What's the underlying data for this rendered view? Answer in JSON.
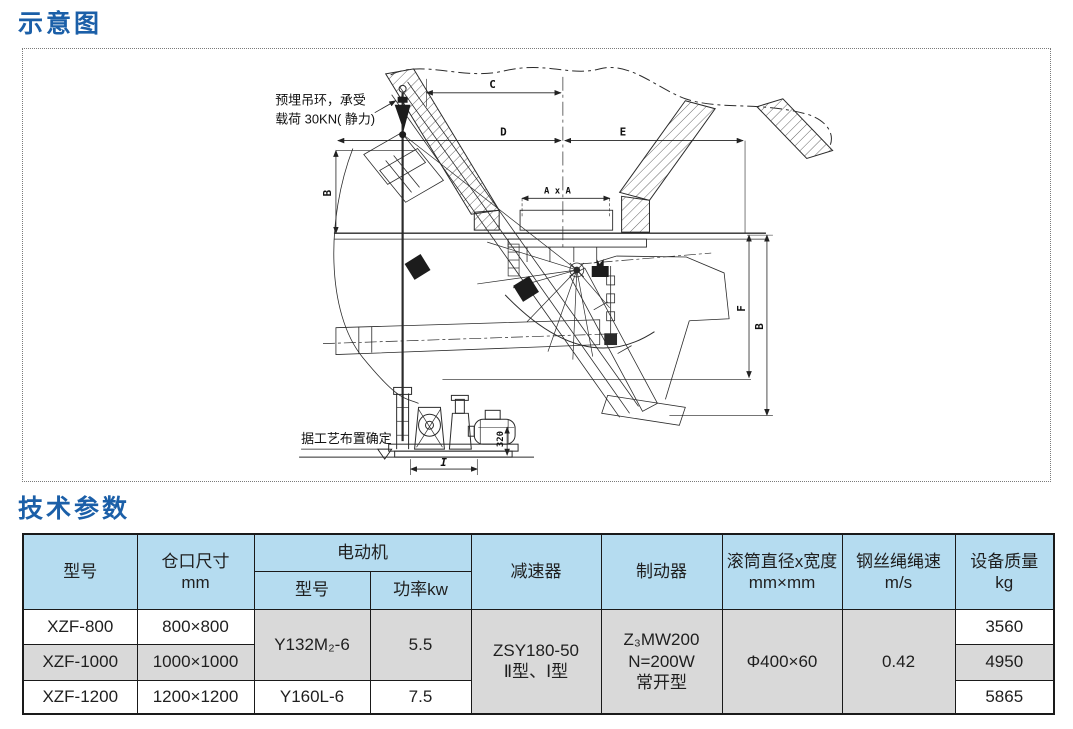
{
  "schematic": {
    "title": "示意图",
    "annotations": {
      "lifting_line1": "预埋吊环，承受",
      "lifting_line2": "载荷 30KN( 静力)",
      "process_note": "据工艺布置确定"
    },
    "dimensions": {
      "c": "C",
      "d": "D",
      "e": "E",
      "axa": "A x A",
      "b_left": "B",
      "f": "F",
      "b_right": "B",
      "i": "I",
      "h320": "320"
    }
  },
  "params": {
    "title": "技术参数",
    "table": {
      "headers": {
        "model": "型号",
        "opening": "仓口尺寸\nmm",
        "motor_group": "电动机",
        "motor_model": "型号",
        "motor_power": "功率kw",
        "reducer": "减速器",
        "brake": "制动器",
        "drum": "滚筒直径x宽度\nmm×mm",
        "rope_speed": "钢丝绳绳速\nm/s",
        "mass": "设备质量\nkg"
      },
      "merged": {
        "motor_model_r12": "Y132M₂-6",
        "motor_power_r12": "5.5",
        "reducer": "ZSY180-50\nⅡ型、Ⅰ型",
        "brake": "Z₃MW200\nN=200W\n常开型",
        "drum": "Φ400×60",
        "rope_speed": "0.42"
      },
      "rows": [
        {
          "model": "XZF-800",
          "opening": "800×800",
          "mass": "3560"
        },
        {
          "model": "XZF-1000",
          "opening": "1000×1000",
          "mass": "4950"
        },
        {
          "model": "XZF-1200",
          "opening": "1200×1200",
          "motor_model": "Y160L-6",
          "motor_power": "7.5",
          "mass": "5865"
        }
      ]
    }
  },
  "colors": {
    "title_blue": "#1b5fa8",
    "header_bg": "#b5dcf0",
    "row_gray": "#d9d9d9",
    "line": "#2b2b2b"
  }
}
